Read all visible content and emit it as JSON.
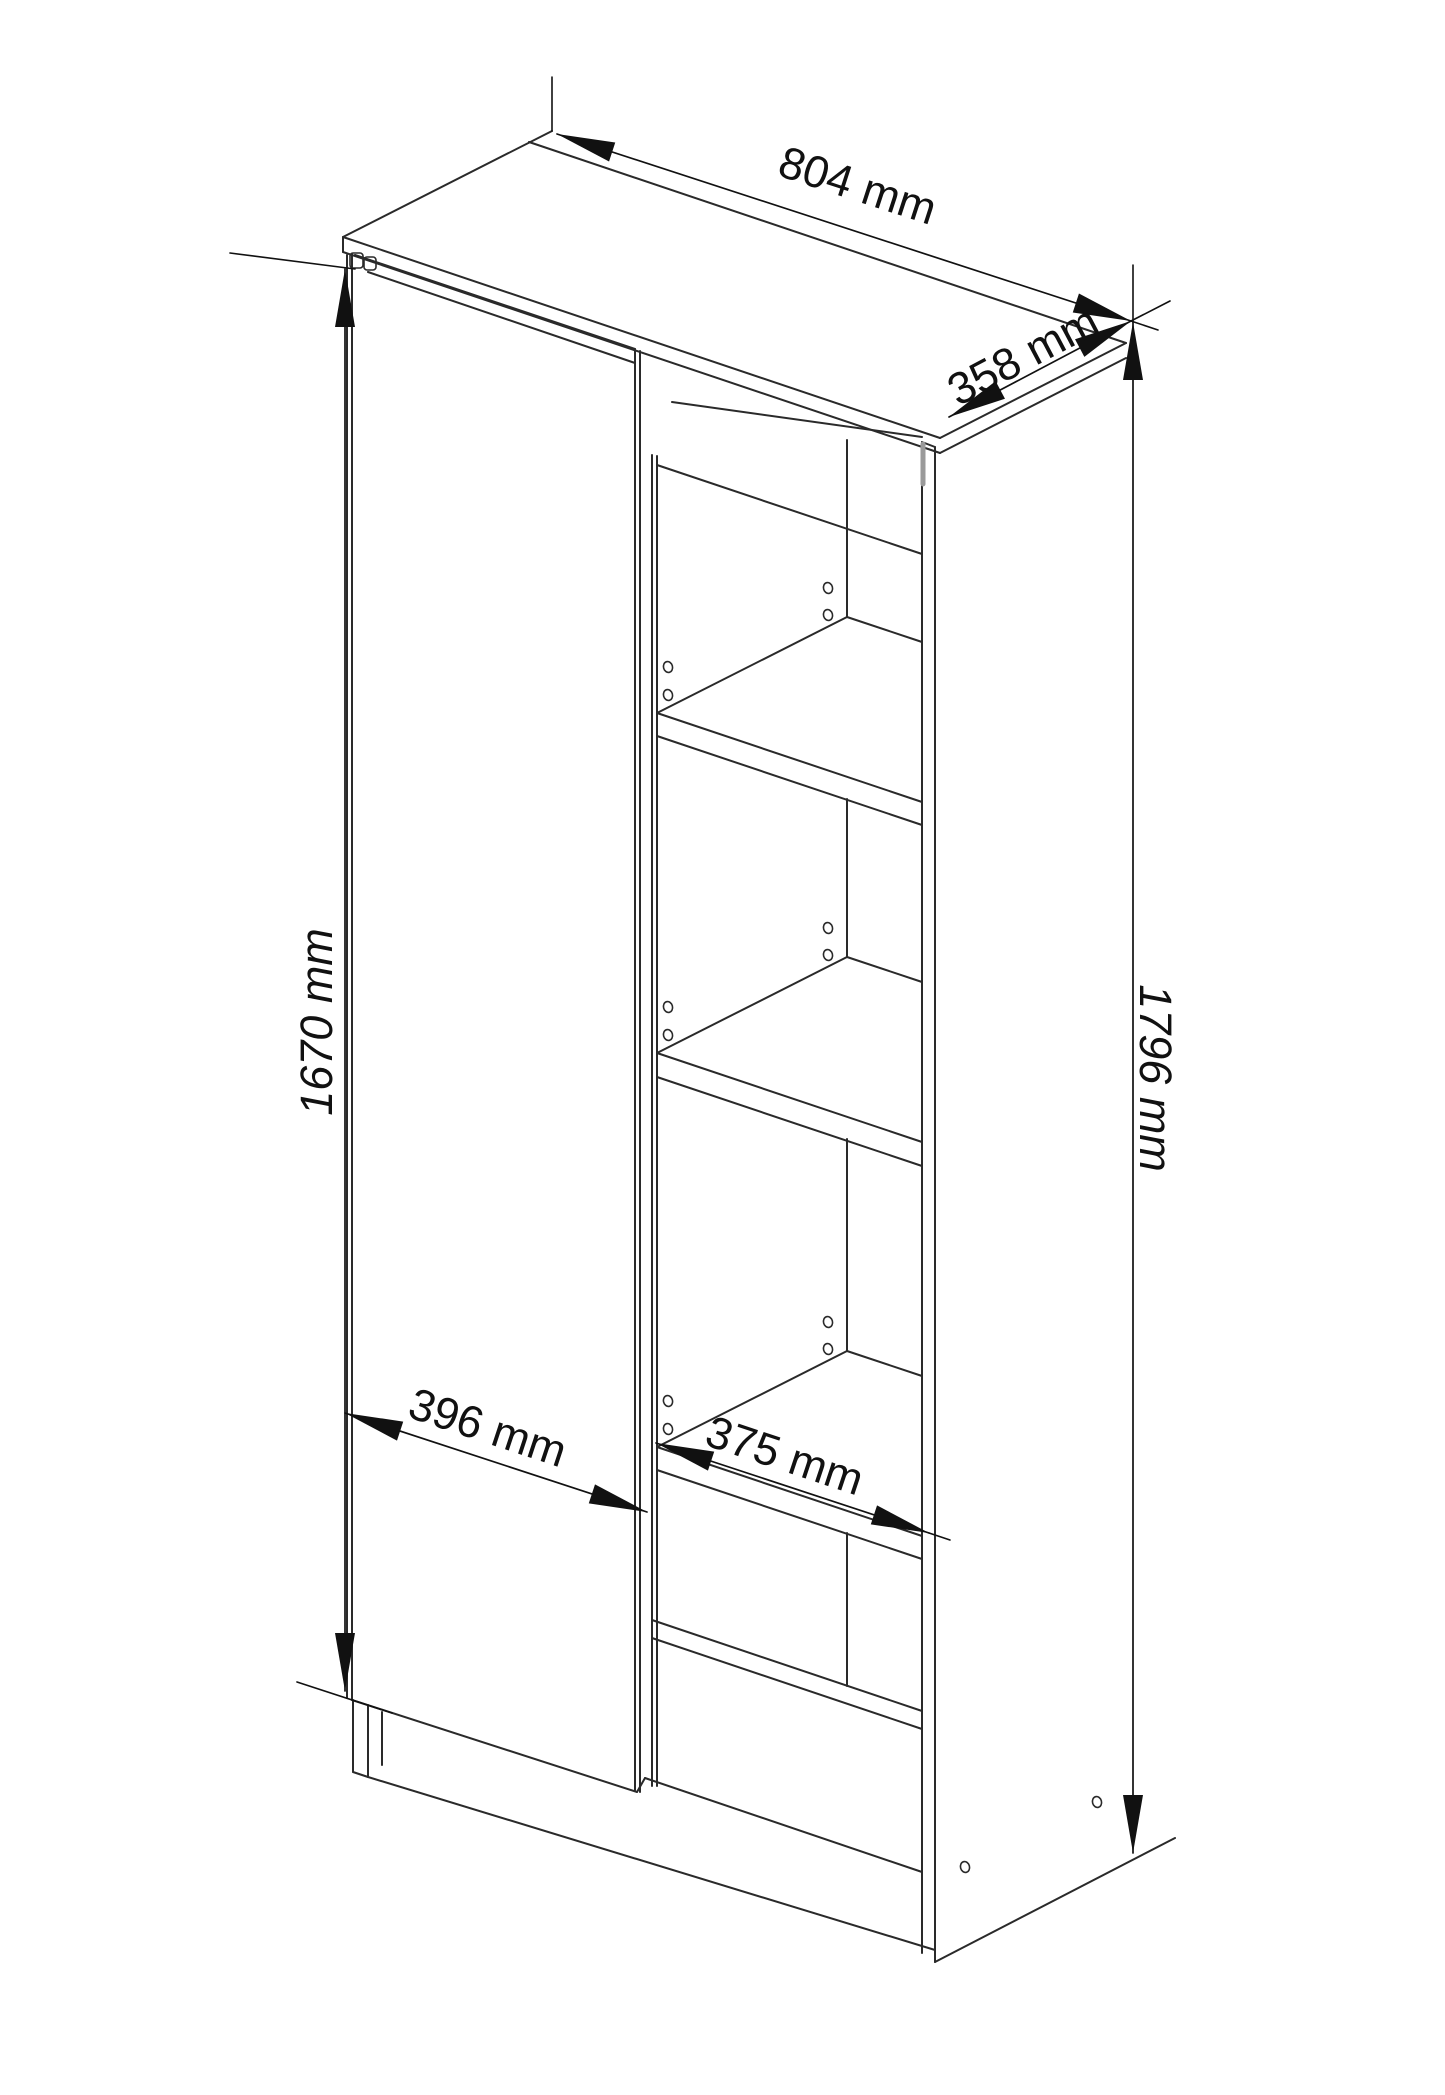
{
  "drawing": {
    "canvas": {
      "width": 1445,
      "height": 2095
    },
    "background_color": "#ffffff",
    "line_color": "#2a2a2a",
    "dim_color": "#111111",
    "font_size": 45,
    "arrow_length": 58,
    "arrow_half_width": 10
  },
  "labels": {
    "width_top": "804 mm",
    "depth_top": "358 mm",
    "height_total": "1796 mm",
    "height_door": "1670 mm",
    "width_door": "396 mm",
    "width_shelf": "375 mm"
  },
  "dimensions": [
    {
      "name": "top-width",
      "label": "804 mm",
      "x1": 557,
      "y1": 134,
      "x2": 1131,
      "y2": 321,
      "tx": 853,
      "ty": 200,
      "angle": 18,
      "italic": false
    },
    {
      "name": "top-depth",
      "label": "358 mm",
      "x1": 949,
      "y1": 417,
      "x2": 1131,
      "y2": 321,
      "tx": 1030,
      "ty": 369,
      "angle": -27.8,
      "italic": false
    },
    {
      "name": "total-height",
      "label": "1796 mm",
      "x1": 1133,
      "y1": 322,
      "x2": 1133,
      "y2": 1853,
      "tx": 1140,
      "ty": 1078,
      "angle": 90,
      "italic": true
    },
    {
      "name": "door-height",
      "label": "1670 mm",
      "x1": 345,
      "y1": 269,
      "x2": 345,
      "y2": 1691,
      "tx": 332,
      "ty": 1022,
      "angle": -90,
      "italic": true
    },
    {
      "name": "door-width",
      "label": "396 mm",
      "x1": 345,
      "y1": 1413,
      "x2": 647,
      "y2": 1512,
      "tx": 483,
      "ty": 1442,
      "angle": 18.3,
      "italic": false
    },
    {
      "name": "shelf-width",
      "label": "375 mm",
      "x1": 656,
      "y1": 1443,
      "x2": 929,
      "y2": 1533,
      "tx": 780,
      "ty": 1470,
      "angle": 18.4,
      "italic": false
    }
  ],
  "cabinet_lines": [
    [
      343,
      237,
      552,
      131
    ],
    [
      529,
      142,
      1126,
      343
    ],
    [
      1126,
      343,
      940,
      438
    ],
    [
      343,
      237,
      940,
      438
    ],
    [
      343,
      252,
      940,
      453
    ],
    [
      343,
      237,
      343,
      252
    ],
    [
      940,
      453,
      1126,
      358
    ],
    [
      355,
      255,
      635,
      349
    ],
    [
      368,
      272,
      635,
      363
    ],
    [
      347,
      255,
      347,
      1698
    ],
    [
      352,
      254,
      352,
      1700
    ],
    [
      635,
      349,
      635,
      1790
    ],
    [
      640,
      351,
      640,
      1792
    ],
    [
      352,
      1700,
      637,
      1792
    ],
    [
      652,
      455,
      652,
      1786
    ],
    [
      657,
      456,
      657,
      1786
    ],
    [
      657,
      465,
      922,
      554
    ],
    [
      672,
      402,
      922,
      437
    ],
    [
      657,
      713,
      922,
      802
    ],
    [
      657,
      736,
      922,
      825
    ],
    [
      657,
      713,
      847,
      617
    ],
    [
      847,
      617,
      922,
      642
    ],
    [
      657,
      1053,
      922,
      1142
    ],
    [
      657,
      1077,
      922,
      1166
    ],
    [
      657,
      1053,
      847,
      957
    ],
    [
      847,
      957,
      922,
      982
    ],
    [
      657,
      1447,
      922,
      1536
    ],
    [
      657,
      1470,
      922,
      1559
    ],
    [
      657,
      1447,
      847,
      1351
    ],
    [
      847,
      1351,
      922,
      1376
    ],
    [
      847,
      440,
      847,
      617
    ],
    [
      847,
      799,
      847,
      957
    ],
    [
      847,
      1139,
      847,
      1351
    ],
    [
      847,
      1533,
      847,
      1686
    ],
    [
      652,
      1620,
      922,
      1711
    ],
    [
      652,
      1638,
      922,
      1729
    ],
    [
      922,
      442,
      922,
      1953
    ],
    [
      935,
      447,
      935,
      1962
    ],
    [
      922,
      442,
      935,
      447
    ],
    [
      935,
      1962,
      1175,
      1838
    ],
    [
      353,
      1700,
      353,
      1772
    ],
    [
      368,
      1705,
      368,
      1777
    ],
    [
      382,
      1712,
      382,
      1765
    ],
    [
      353,
      1772,
      368,
      1777
    ],
    [
      368,
      1777,
      935,
      1950
    ],
    [
      637,
      1792,
      645,
      1778
    ],
    [
      645,
      1778,
      922,
      1872
    ]
  ],
  "aux_lines": [
    [
      552,
      77,
      552,
      131
    ],
    [
      230,
      253,
      355,
      269
    ],
    [
      297,
      1682,
      392,
      1713
    ],
    [
      1133,
      265,
      1133,
      322
    ],
    [
      1131,
      321,
      1170,
      301
    ],
    [
      1131,
      321,
      1158,
      330
    ],
    [
      929,
      1533,
      950,
      1540
    ]
  ],
  "shelf_pin_holes": [
    [
      668,
      667
    ],
    [
      668,
      695
    ],
    [
      828,
      588
    ],
    [
      828,
      615
    ],
    [
      668,
      1007
    ],
    [
      668,
      1035
    ],
    [
      828,
      928
    ],
    [
      828,
      955
    ],
    [
      668,
      1401
    ],
    [
      668,
      1429
    ],
    [
      828,
      1322
    ],
    [
      828,
      1349
    ]
  ],
  "panel_marks": [
    [
      1097,
      1802
    ],
    [
      965,
      1867
    ]
  ],
  "hinge_notches": [
    [
      350,
      253,
      13,
      15
    ],
    [
      364,
      257,
      12,
      13
    ]
  ],
  "gap_shadows": [
    [
      923,
      444,
      923,
      484
    ]
  ]
}
